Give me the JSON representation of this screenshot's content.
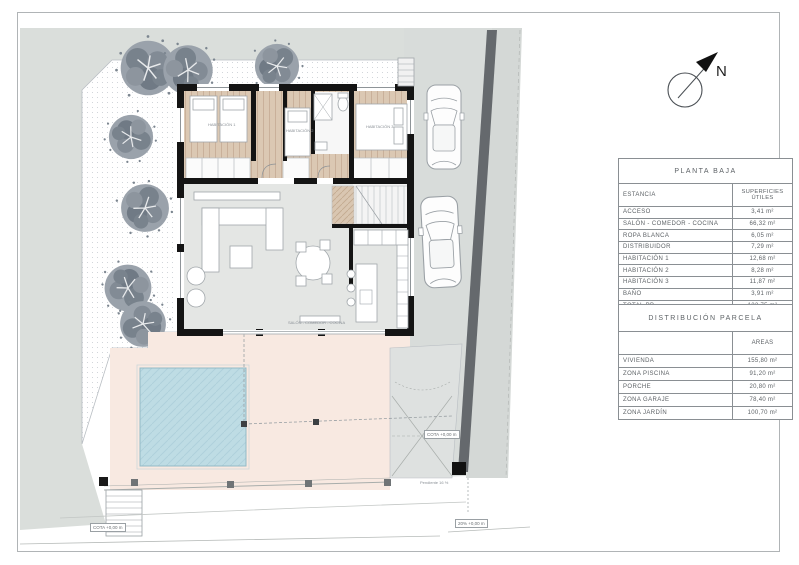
{
  "north_arrow": {
    "label": "N"
  },
  "tables": {
    "planta_baja": {
      "title": "PLANTA BAJA",
      "col1_header": "ESTANCIA",
      "col2_header": "SUPERFICIES ÚTILES",
      "rows": [
        {
          "label": "ACCESO",
          "value": "3,41 m²"
        },
        {
          "label": "SALÓN - COMEDOR - COCINA",
          "value": "66,32 m²"
        },
        {
          "label": "ROPA BLANCA",
          "value": "6,05 m²"
        },
        {
          "label": "DISTRIBUIDOR",
          "value": "7,29 m²"
        },
        {
          "label": "HABITACIÓN 1",
          "value": "12,68 m²"
        },
        {
          "label": "HABITACIÓN 2",
          "value": "8,28 m²"
        },
        {
          "label": "HABITACIÓN 3",
          "value": "11,87 m²"
        },
        {
          "label": "BAÑO",
          "value": "3,91 m²"
        },
        {
          "label": "TOTAL PB",
          "value": "122,75 m²"
        }
      ]
    },
    "distribucion_parcela": {
      "title": "DISTRIBUCIÓN PARCELA",
      "col1_header": "",
      "col2_header": "AREAS",
      "rows": [
        {
          "label": "VIVIENDA",
          "value": "155,80 m²"
        },
        {
          "label": "ZONA PISCINA",
          "value": "91,20 m²"
        },
        {
          "label": "PORCHE",
          "value": "20,80 m²"
        },
        {
          "label": "ZONA GARAJE",
          "value": "78,40 m²"
        },
        {
          "label": "ZONA JARDÍN",
          "value": "100,70 m²"
        }
      ]
    }
  },
  "plan_labels": {
    "rooms": {
      "salon": "SALÓN - COMEDOR - COCINA",
      "hab1": "HABITACIÓN 1",
      "hab2": "HABITACIÓN 2",
      "hab3": "HABITACIÓN 3"
    },
    "cotas": {
      "gate": "COTA +0,00 m",
      "street": "20% +0,00 m",
      "stairs": "COTA +0,00 m",
      "pendiente": "Pendiente 16 %"
    }
  },
  "colors": {
    "wall": "#141414",
    "wood_floor": "#dbc8b3",
    "living_floor": "#e4e6e4",
    "terrace_pink": "#f8e9e1",
    "pool_blue": "#bedce4",
    "street_gray": "#dadedb",
    "dark_wall": "#65696d",
    "tree_gray": "#8a929c",
    "table_line": "#8a8f93",
    "text_gray": "#5d6266"
  }
}
